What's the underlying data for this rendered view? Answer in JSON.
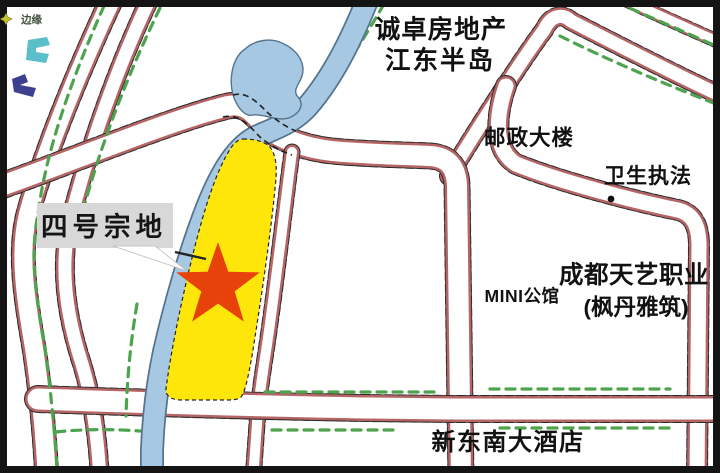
{
  "map": {
    "legend": {
      "label": "边缘"
    },
    "callout": {
      "label": "四号宗地"
    },
    "landmarks": {
      "developer_line1": "诚卓房地产",
      "developer_line2": "江东半岛",
      "post_building": "邮政大楼",
      "health_enforcement": "卫生执法",
      "mini_mansion": "MINI公馆",
      "tianyi_line1": "成都天艺职业",
      "tianyi_line2": "(枫丹雅筑)",
      "hotel": "新东南大酒店"
    },
    "colors": {
      "parcel_yellow": "#ffe60a",
      "star_red": "#e8420b",
      "river_blue": "#a6c8e2",
      "river_edge": "#56748e",
      "road_edge_red": "#b56565",
      "road_edge_dark": "#2a2a2a",
      "tree_green": "#4ea34e",
      "building_cyan": "#5bbfcb",
      "building_purple": "#3d3f90",
      "label_box_gray": "#d8d8d8",
      "frame_black": "#141414"
    }
  }
}
